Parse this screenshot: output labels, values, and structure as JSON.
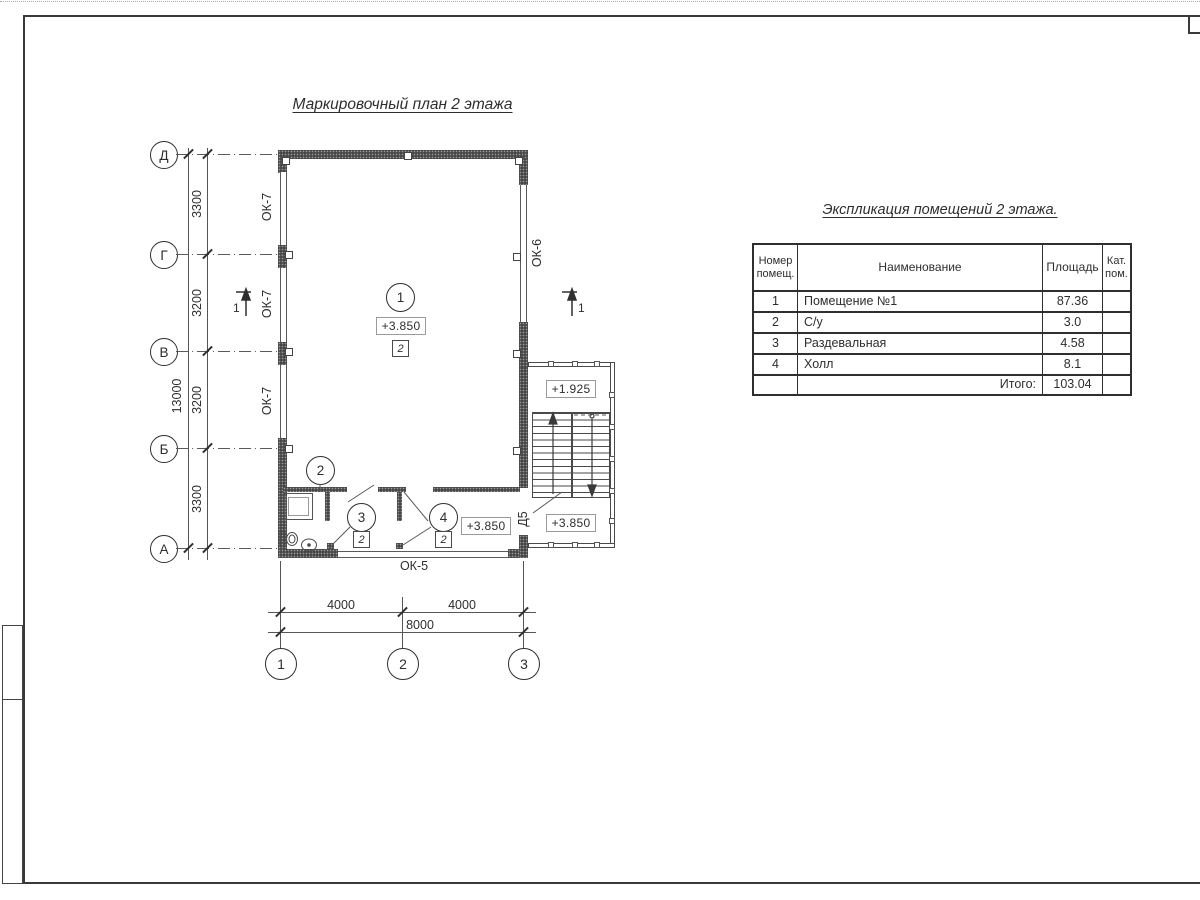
{
  "titles": {
    "plan": "Маркировочный план 2 этажа",
    "table": "Экспликация помещений 2 этажа."
  },
  "plan": {
    "axes_v": [
      "Д",
      "Г",
      "В",
      "Б",
      "А"
    ],
    "axes_h": [
      "1",
      "2",
      "3"
    ],
    "dims_left": [
      "3300",
      "3200",
      "3200",
      "3300"
    ],
    "dim_total_left": "13000",
    "dims_bottom": [
      "4000",
      "4000"
    ],
    "dim_total_bottom": "8000",
    "window_labels": {
      "left": "ОК-7",
      "right": "ОК-6",
      "bottom": "ОК-5"
    },
    "door_label": "Д5",
    "section_label": "1",
    "room_nums": [
      "1",
      "2",
      "3",
      "4"
    ],
    "type_mark": "2",
    "elevations": {
      "room1": "+3.850",
      "hall": "+3.850",
      "annex_upper": "+1.925",
      "annex_lower": "+3.850"
    }
  },
  "table": {
    "headers": {
      "num": "Номер помещ.",
      "name": "Наименование",
      "area": "Площадь",
      "cat": "Кат. пом."
    },
    "rows": [
      {
        "num": "1",
        "name": "Помещение №1",
        "area": "87.36",
        "cat": ""
      },
      {
        "num": "2",
        "name": "С/у",
        "area": "3.0",
        "cat": ""
      },
      {
        "num": "3",
        "name": "Раздевальная",
        "area": "4.58",
        "cat": ""
      },
      {
        "num": "4",
        "name": "Холл",
        "area": "8.1",
        "cat": ""
      }
    ],
    "total_label": "Итого:",
    "total_value": "103.04"
  }
}
